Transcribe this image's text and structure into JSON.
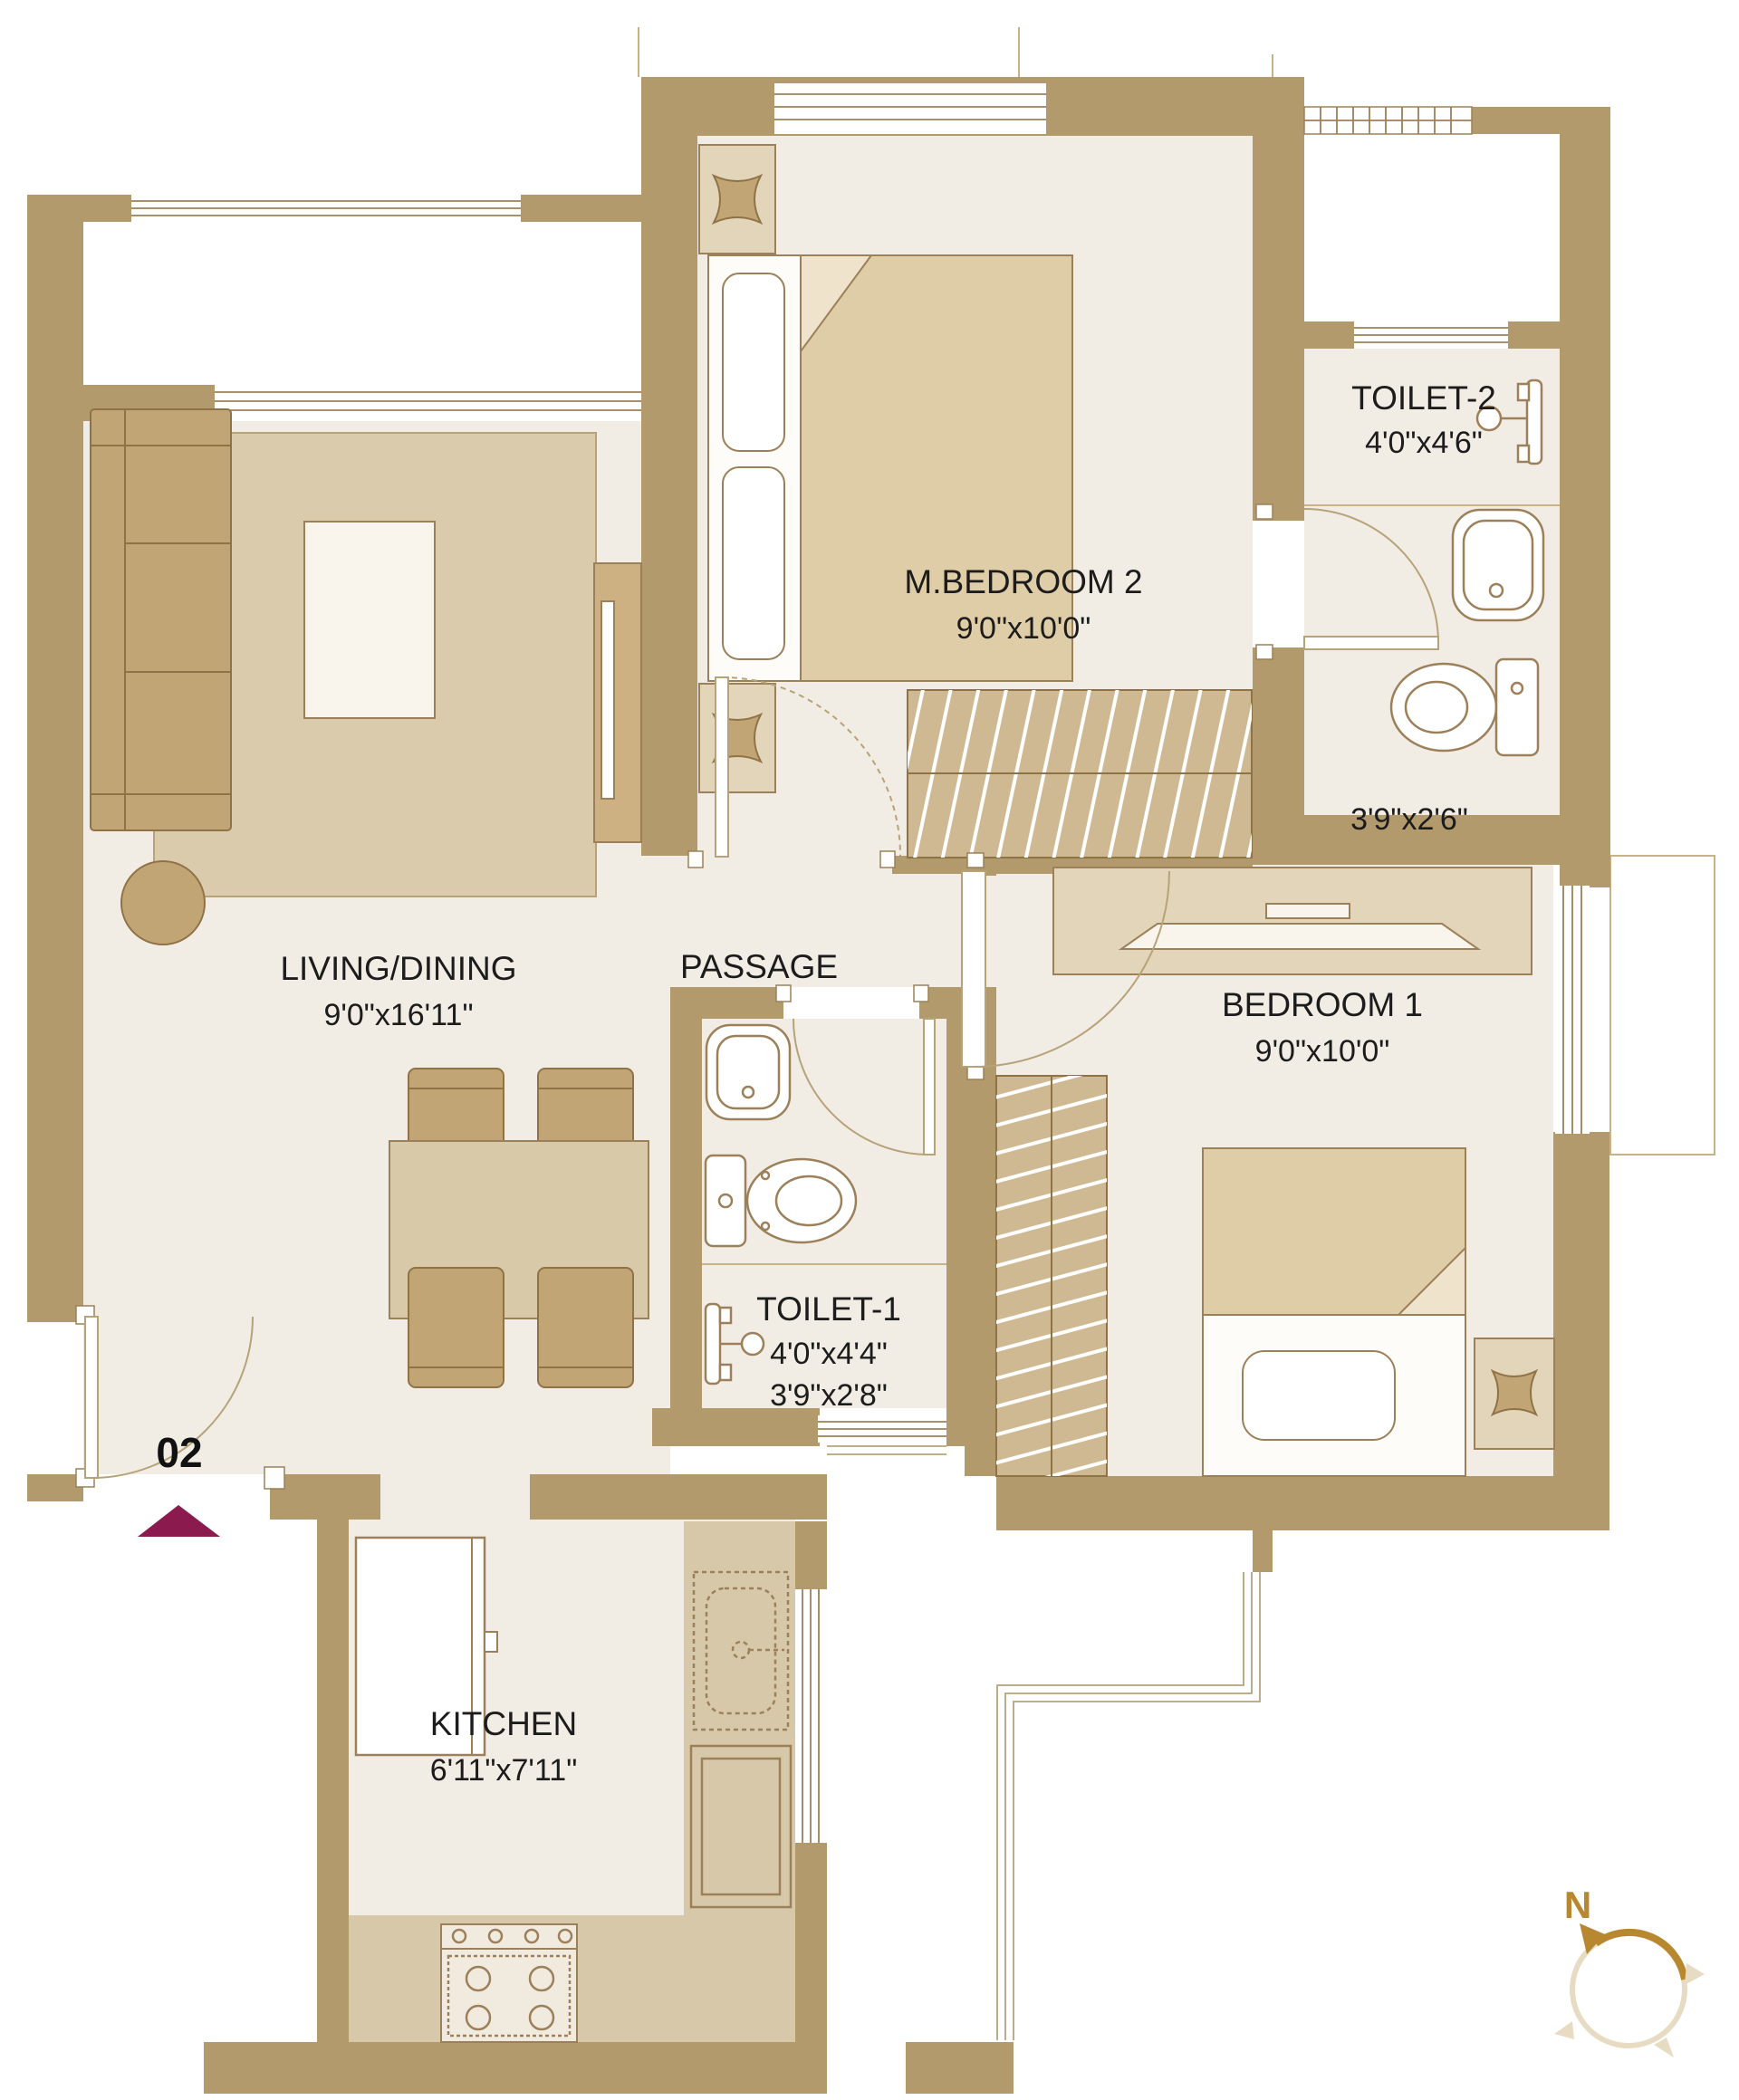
{
  "unit": {
    "number": "02"
  },
  "compass": {
    "north": "N"
  },
  "rooms": {
    "living": {
      "label": "LIVING/DINING",
      "dims": "9'0\"x16'11\""
    },
    "passage": {
      "label": "PASSAGE"
    },
    "mbedroom2": {
      "label": "M.BEDROOM 2",
      "dims": "9'0\"x10'0\""
    },
    "toilet2": {
      "label": "TOILET-2",
      "dims": "4'0\"x4'6\"",
      "sub_dims": "3'9\"x2'6\""
    },
    "bedroom1": {
      "label": "BEDROOM 1",
      "dims": "9'0\"x10'0\""
    },
    "toilet1": {
      "label": "TOILET-1",
      "dims": "4'0\"x4'4\"",
      "sub_dims": "3'9\"x2'8\""
    },
    "kitchen": {
      "label": "KITCHEN",
      "dims": "6'11\"x7'11\""
    }
  },
  "colors": {
    "wall": "#b29a6c",
    "floor": "#f1ece4",
    "entry_marker": "#8b1a4f",
    "compass_gold": "#b7882f"
  }
}
